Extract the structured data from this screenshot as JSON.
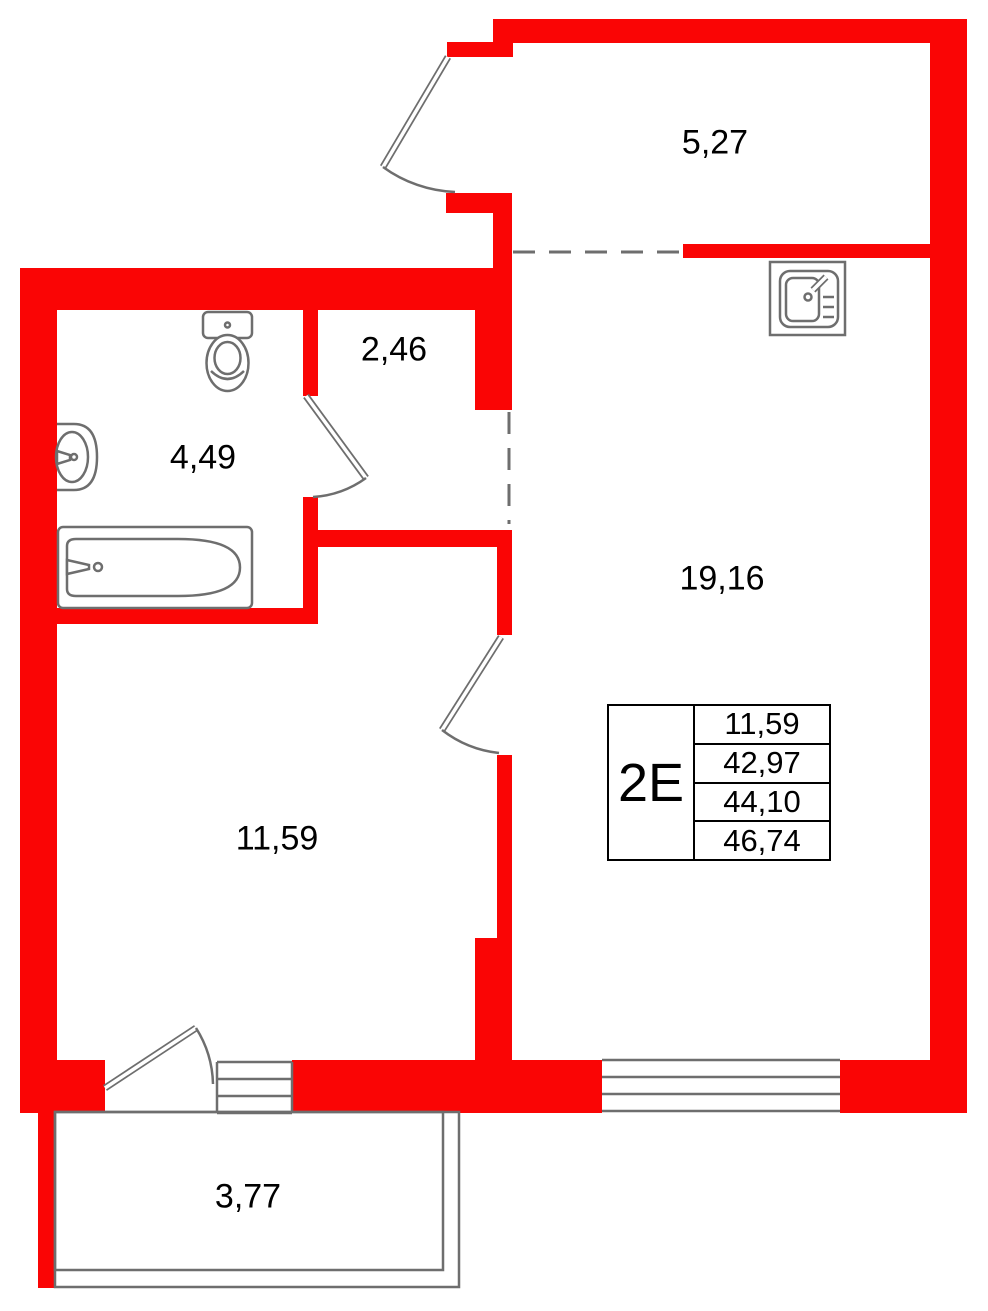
{
  "plan": {
    "title": "apartment floor plan",
    "unit_info_table": {
      "unit_type": "2E",
      "area_values": [
        "11,59",
        "42,97",
        "44,10",
        "46,74"
      ]
    },
    "rooms": [
      {
        "id": "top-terrace",
        "area_label": "5,27"
      },
      {
        "id": "hallway",
        "area_label": "2,46"
      },
      {
        "id": "bathroom",
        "area_label": "4,49"
      },
      {
        "id": "kitchen-living-room",
        "area_label": "19,16"
      },
      {
        "id": "bedroom",
        "area_label": "11,59"
      },
      {
        "id": "balcony",
        "area_label": "3,77"
      }
    ],
    "fixtures": [
      "toilet",
      "bathroom-sink",
      "bathtub",
      "kitchen-sink"
    ],
    "openings": [
      "entry-door",
      "bathroom-door",
      "living-room-door",
      "balcony-door",
      "balcony-window",
      "living-room-window"
    ],
    "colors": {
      "wall": "#fa0505",
      "line": "#6e6e6e",
      "text": "#000000",
      "bg": "#ffffff"
    }
  }
}
